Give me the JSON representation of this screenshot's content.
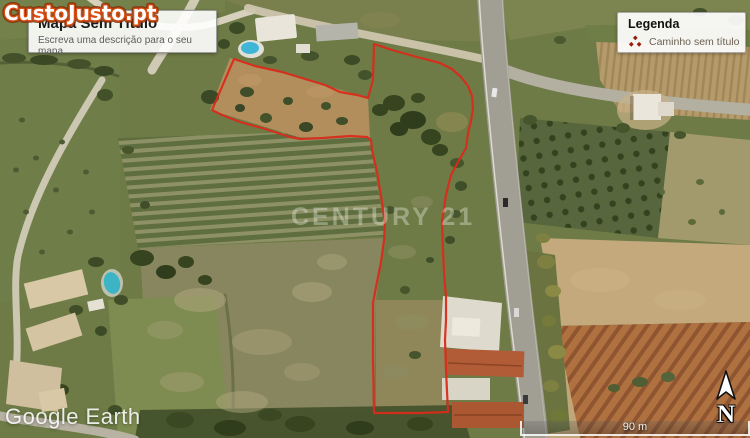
{
  "watermarks": {
    "custojusto": "CustoJusto.pt",
    "century": "CENTURY 21",
    "google_earth": "Google Earth"
  },
  "title_box": {
    "title": "Mapa Sem Título",
    "description": "Escreva uma descrição para o seu mapa."
  },
  "legend": {
    "title": "Legenda",
    "items": [
      {
        "label": "Caminho sem título",
        "color": "#9b1c0e"
      }
    ]
  },
  "scale_bar": {
    "label": "90 m"
  },
  "compass": {
    "label": "N"
  },
  "map": {
    "path_color": "#d92b1b",
    "path_points": "234,59 255,66 282,72 305,79 325,85 340,92 357,95 368,98 373,80 374,44 392,50 417,57 440,63 452,69 461,77 468,86 472,96 473,108 471,121 468,133 466,148 458,162 451,175 446,195 442,222 443,250 444,273 446,297 446,320 445,340 446,370 448,412 420,413 374,413 373,360 373,303 376,287 381,262 384,240 385,222 381,196 377,172 372,150 371,140 367,137 350,136 323,138 300,139 290,137 262,128 240,122 222,115 212,110 234,59"
  },
  "colors": {
    "legend_accent": "#9b1c0e",
    "custojusto_orange": "#d94e12",
    "road_gray": "#a19f94",
    "field_green": "#6e7b46"
  }
}
